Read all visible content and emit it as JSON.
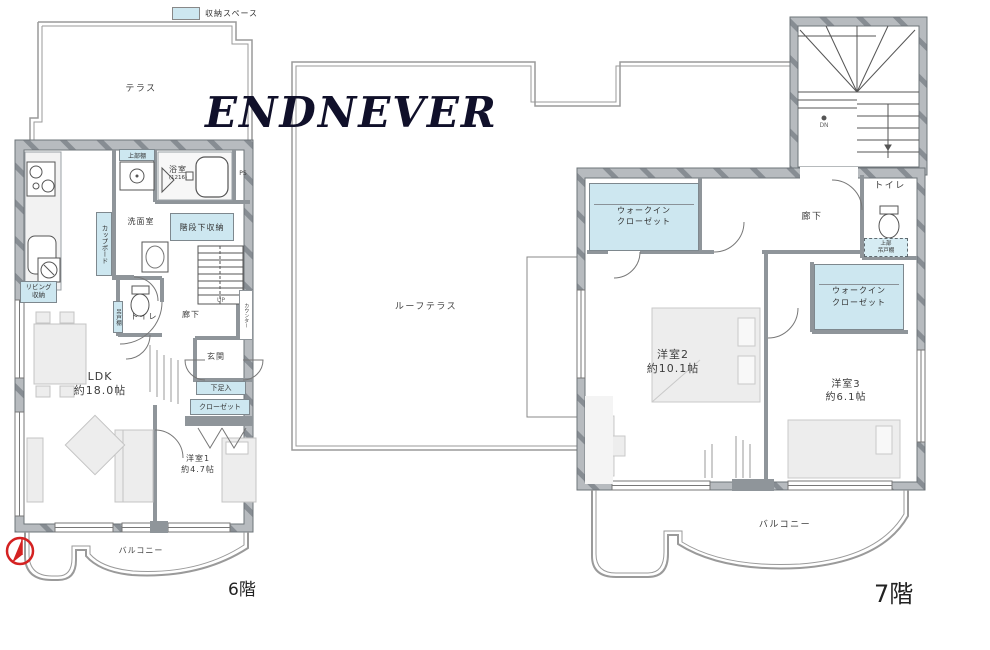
{
  "legend": {
    "label": "収納スペース"
  },
  "watermark": "ENDNEVER",
  "colors": {
    "storage": "#cde7f0",
    "wall": "#b7bbbf",
    "wall_hatch": "#878d93",
    "watermark": "#10102a",
    "compass": "#d42222"
  },
  "floor6": {
    "floor_label": "6階",
    "terrace_label": "テラス",
    "balcony_label": "バルコニー",
    "labels": {
      "upper_shelf": "上部棚",
      "bath_name": "浴室",
      "bath_size": "(1216)",
      "ps": "PS",
      "washroom": "洗面室",
      "cupboard": "カップボード",
      "under_stair_storage": "階段下収納",
      "living_storage_line1": "リビング",
      "living_storage_line2": "収納",
      "toilet": "トイレ",
      "hanging_cabinet": "吊戸棚",
      "hallway": "廊下",
      "up": "UP",
      "counter": "カウンター",
      "entrance": "玄関",
      "shoe_box": "下足入",
      "closet": "クローゼット",
      "ldk_name": "LDK",
      "ldk_size": "約18.0帖",
      "room1_name": "洋室1",
      "room1_size": "約4.7帖"
    }
  },
  "floor7": {
    "floor_label": "7階",
    "roof_terrace_label": "ルーフテラス",
    "balcony_label": "バルコニー",
    "labels": {
      "dn": "DN",
      "toilet": "トイレ",
      "hallway": "廊下",
      "wic_line1": "ウォークイン",
      "wic_line2": "クローゼット",
      "hanging_line1": "上部",
      "hanging_line2": "吊戸棚",
      "room2_name": "洋室2",
      "room2_size": "約10.1帖",
      "room3_name": "洋室3",
      "room3_size": "約6.1帖"
    }
  }
}
